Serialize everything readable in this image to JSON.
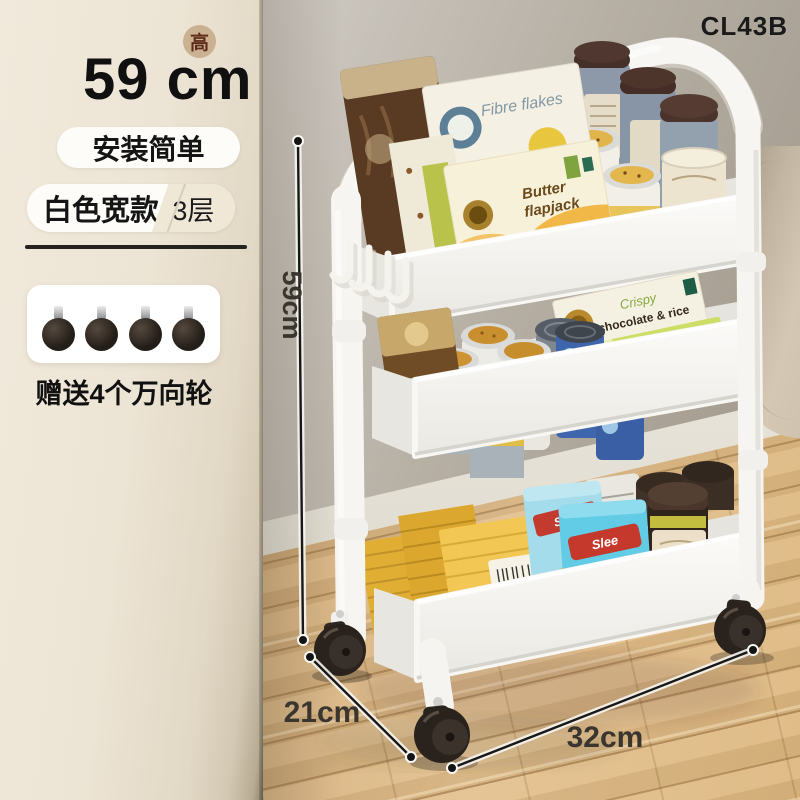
{
  "product_code": "CL43B",
  "info_panel": {
    "badge": "高",
    "height_title": "59 cm",
    "tag_install": "安装简单",
    "tag_color": "白色宽款",
    "tag_tiers": "3层",
    "gift_caption": "赠送4个万向轮",
    "gift_wheel_count": 4
  },
  "dimensions": {
    "height": "59cm",
    "depth": "21cm",
    "width": "32cm"
  },
  "cart_products": {
    "fibre_flakes": "Fibre flakes",
    "butter_line1": "Butter",
    "butter_line2": "flapjack",
    "oatmeal": "OATMEAL",
    "rice_line1": "RICE",
    "rice_line2": "CAKES",
    "crispy": "Crispy",
    "choc_rice": "chocolate & rice",
    "green_flapjack": "flapjack",
    "cornmeal": "CORNMEAL",
    "snack_brand": "Slee",
    "wafer_script": "Wafer"
  },
  "palette": {
    "panel_cream": "#e9e1d1",
    "wall_gray": "#b3aca1",
    "floor_wood": "#d8b283",
    "cart_white": "#f7f6f3",
    "wheel_black": "#2a231d",
    "badge_bg": "#c9b191",
    "badge_text": "#5f2c1c",
    "dimension_text": "#3a362f"
  }
}
